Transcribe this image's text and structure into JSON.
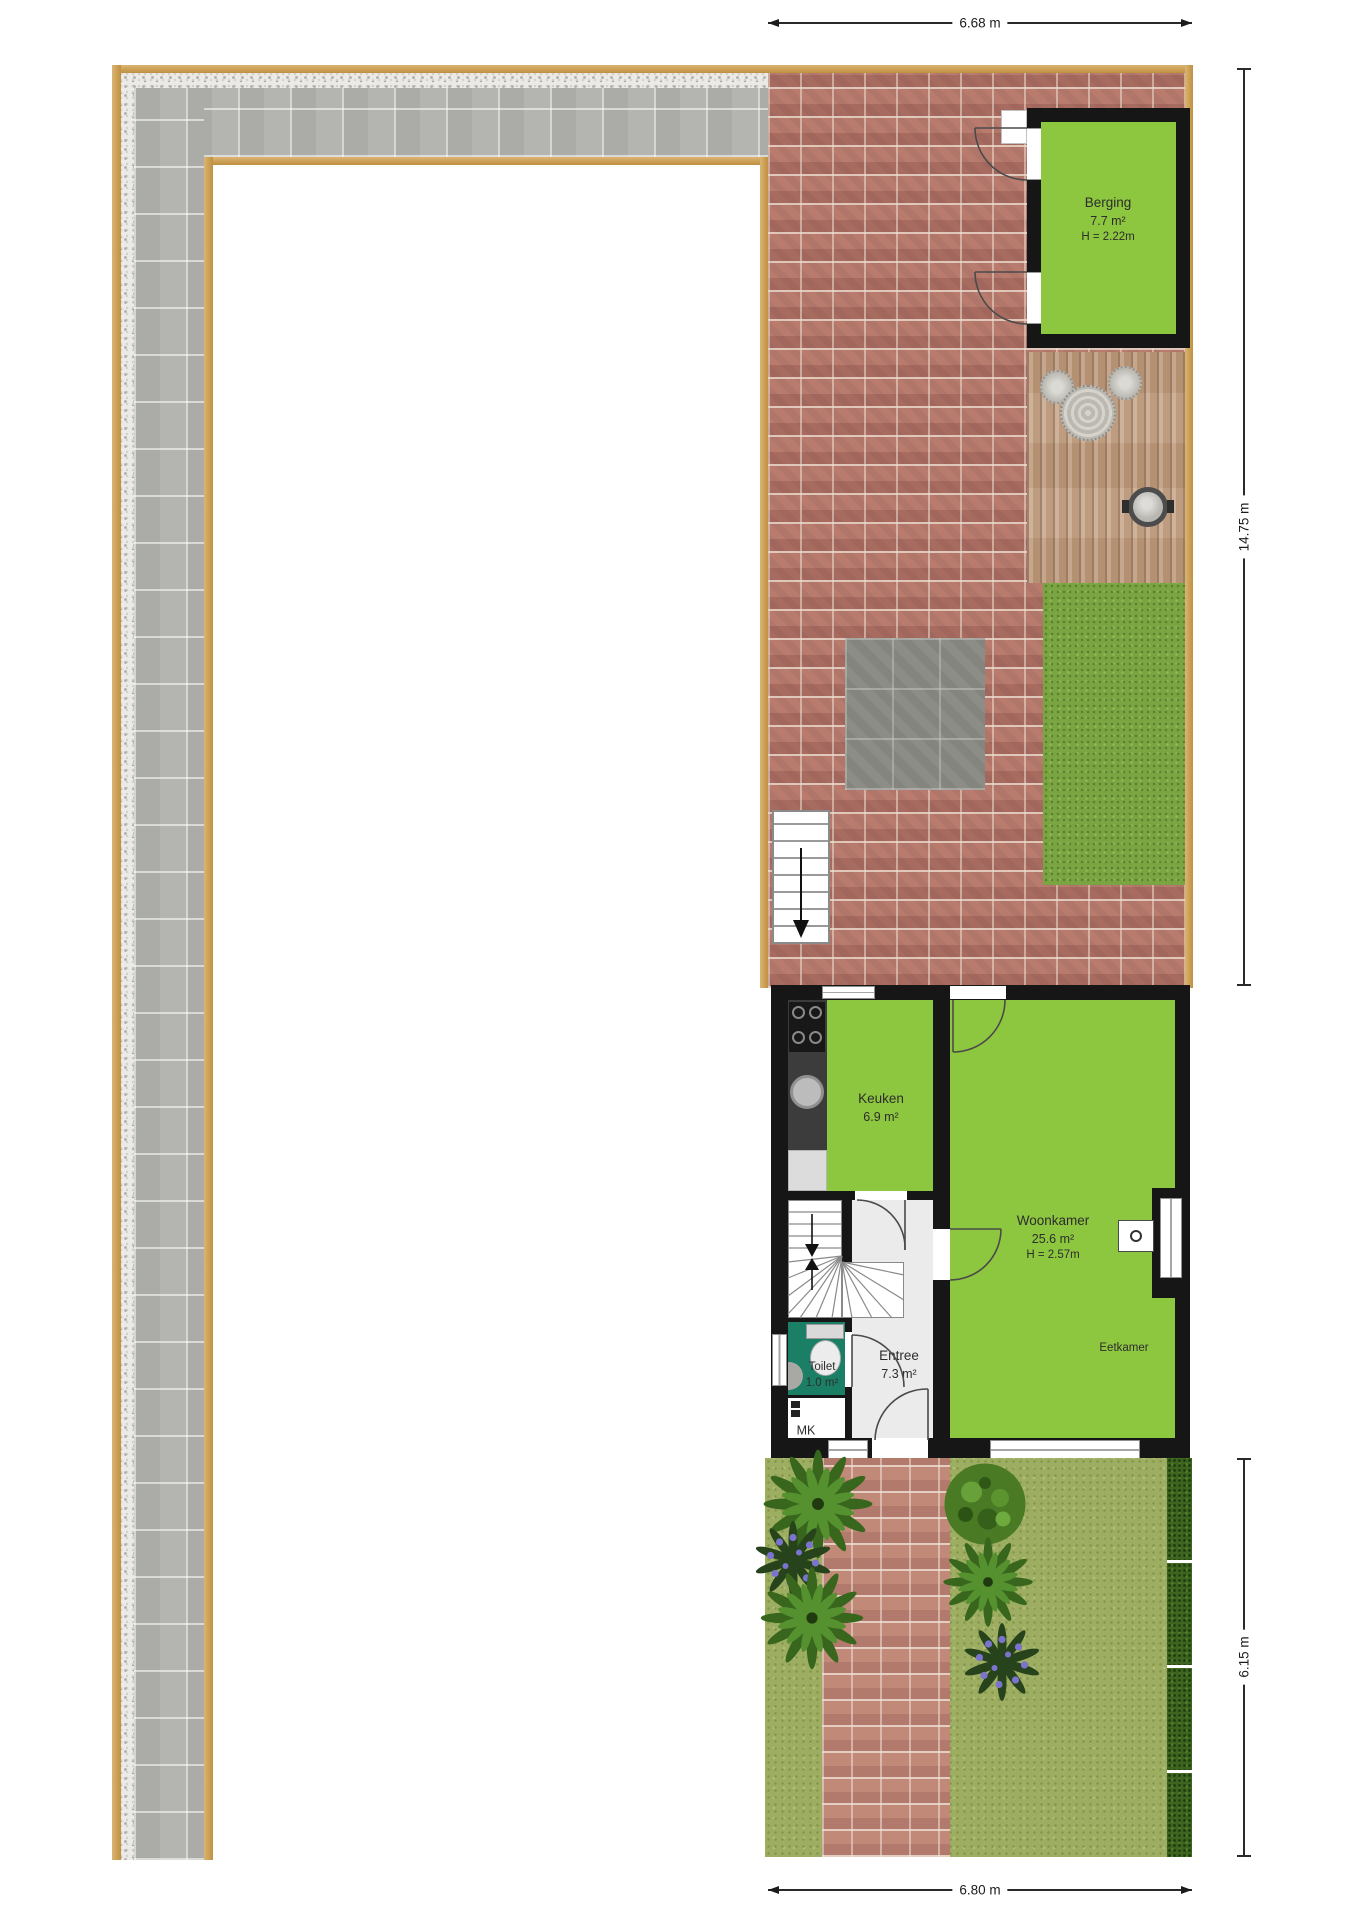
{
  "rooms": {
    "berging": {
      "name": "Berging",
      "area": "7.7 m²",
      "height": "H = 2.22m"
    },
    "keuken": {
      "name": "Keuken",
      "area": "6.9 m²"
    },
    "woonkamer": {
      "name": "Woonkamer",
      "area": "25.6 m²",
      "height": "H = 2.57m"
    },
    "eetkamer": {
      "name": "Eetkamer"
    },
    "entree": {
      "name": "Entree",
      "area": "7.3 m²"
    },
    "toilet": {
      "name": "Toilet",
      "area": "1.0 m²"
    },
    "mk": {
      "name": "MK"
    }
  },
  "dimensions": {
    "top": "6.68 m",
    "side_upper": "14.75 m",
    "side_lower": "6.15 m",
    "bottom": "6.80 m"
  },
  "colors": {
    "room-green": "#8dc63f",
    "toilet-teal": "#1b7f66",
    "wall-black": "#161616",
    "brick": "#b3756a",
    "garden-brick": "#bb8374",
    "paving-gray": "#b4b4b0",
    "border-tan": "#cf9c45",
    "grass-upper": "#7ba442",
    "grass-garden": "#9dae62",
    "hedge-green": "#3e651f",
    "deck-wood": "#c4a183",
    "entree-gray": "#ebebeb"
  }
}
